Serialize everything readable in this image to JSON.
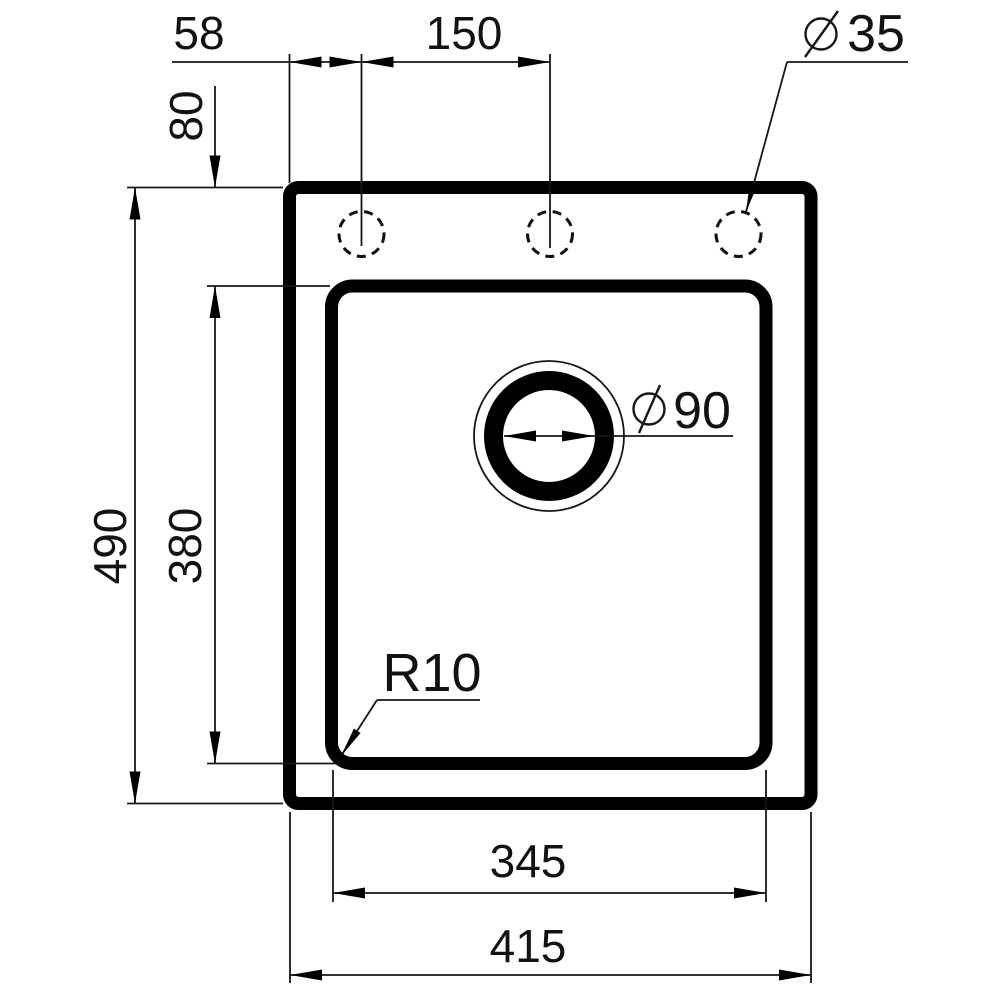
{
  "drawing": {
    "kind": "technical dimension drawing (sink top view)",
    "units": "mm",
    "line_color": "#000000",
    "background": "#ffffff"
  },
  "labels": {
    "diameter_symbol": "∅",
    "top_offset_left": "58",
    "hole_spacing": "150",
    "mounting_hole_diameter": "35",
    "rim_to_bowl": "80",
    "overall_height": "490",
    "bowl_height": "380",
    "drain_diameter": "90",
    "corner_radius": "R10",
    "bowl_width": "345",
    "overall_width": "415"
  }
}
